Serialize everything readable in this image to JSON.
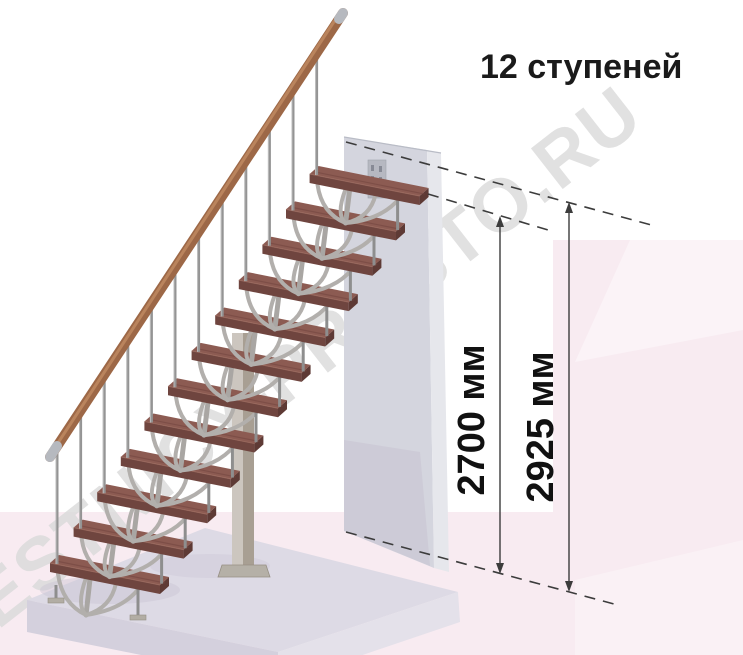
{
  "title": "12 ступеней",
  "watermark": "LESTNICY-PROSTO.RU",
  "stairs": {
    "steps_count": 12,
    "description_label": "12 ступеней"
  },
  "dimensions": [
    {
      "label": "2700 мм",
      "value": 2700,
      "unit": "мм"
    },
    {
      "label": "2925 мм",
      "value": 2925,
      "unit": "мм"
    }
  ],
  "colors": {
    "background": "#ffffff",
    "pink_region": "#f8ebf1",
    "pink_region_light": "#fbf3f7",
    "watermark_gray": "#dadada",
    "tread_top": "#8c5b52",
    "tread_front": "#6f453f",
    "tread_side": "#5e3a35",
    "handrail_wood": "#9d6847",
    "metal_gray": "#949494",
    "wall_face": "#d4d5de",
    "wall_edge": "#e6e7ec",
    "slab_top": "#dddae5",
    "slab_front": "#d4d0dd",
    "dimension_line": "#3c3c3c",
    "text_black": "#1a1a1a"
  }
}
